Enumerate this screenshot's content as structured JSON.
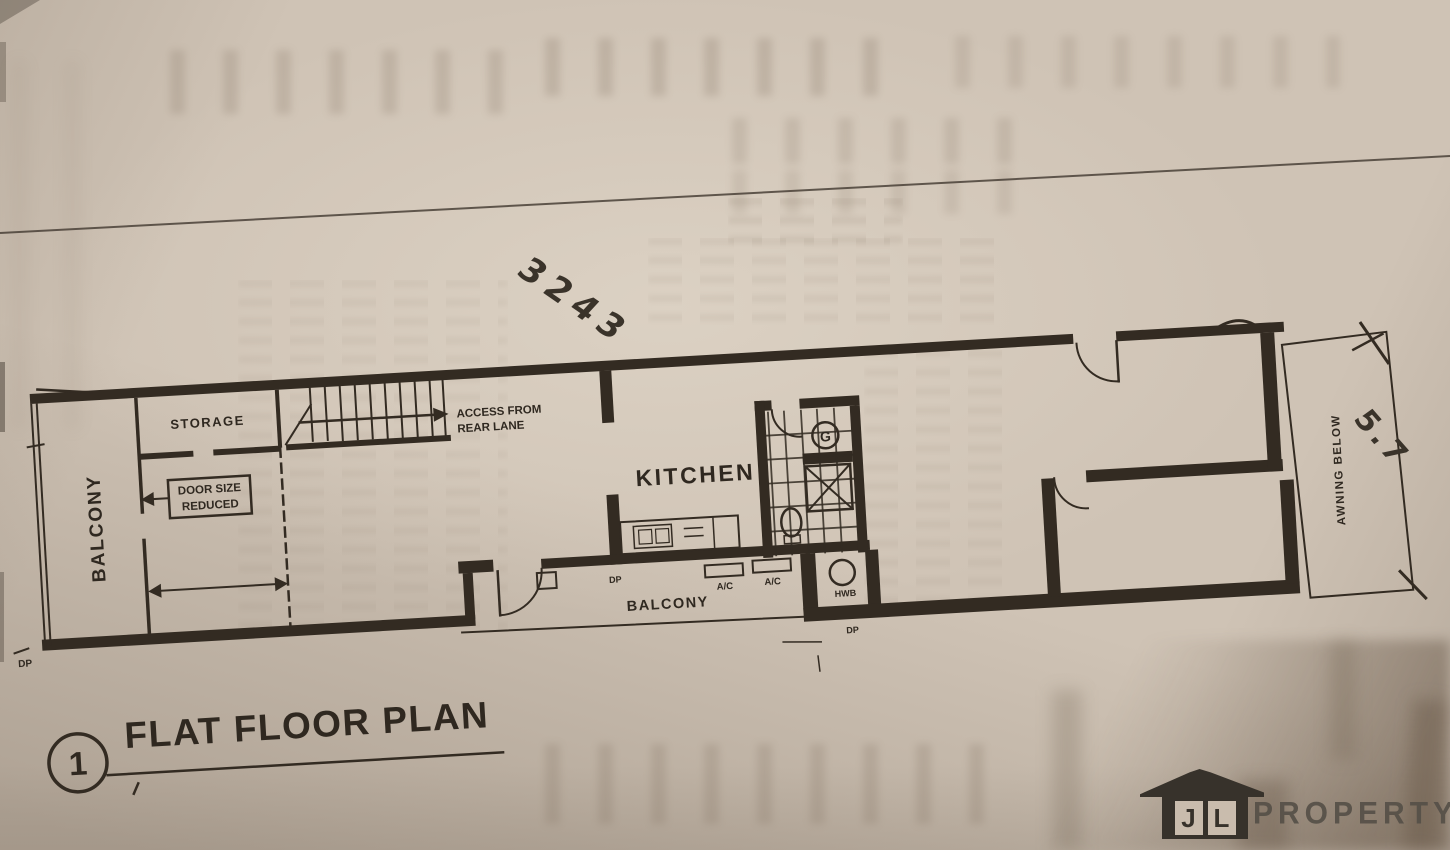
{
  "document": {
    "title": "FLAT FLOOR PLAN",
    "detail_number": "1"
  },
  "plan": {
    "rooms": {
      "balcony_left": "BALCONY",
      "storage": "STORAGE",
      "kitchen": "KITCHEN",
      "balcony_bottom": "BALCONY",
      "awning": "AWNING BELOW"
    },
    "notes": {
      "door_note_line1": "DOOR SIZE",
      "door_note_line2": "REDUCED",
      "access_line1": "ACCESS FROM",
      "access_line2": "REAR LANE"
    },
    "fixtures": {
      "ac1": "A/C",
      "ac2": "A/C",
      "hwb": "HWB",
      "gas": "G",
      "dp_kitchen": "DP",
      "dp_bottom": "DP",
      "dp_edge": "DP"
    },
    "handwritten": {
      "dimension_top": "3243",
      "dimension_right": "5.7"
    }
  },
  "watermark": {
    "logo_letter_j": "J",
    "logo_letter_l": "L",
    "logo_text": "PROPERTY"
  },
  "colors": {
    "paper": "#cfc3b5",
    "ink": "#332b22",
    "logo_house": "#37322b",
    "logo_text": "#565048"
  }
}
